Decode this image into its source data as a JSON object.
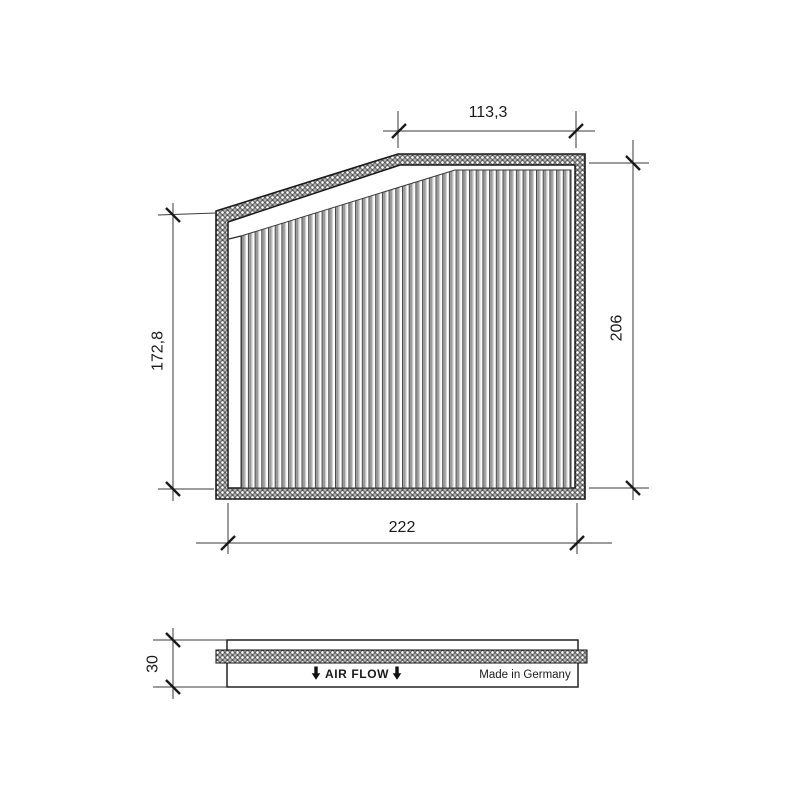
{
  "drawing": {
    "dimensions": {
      "top_width": "113,3",
      "left_height": "172,8",
      "right_height": "206",
      "bottom_width": "222",
      "thickness": "30"
    },
    "labels": {
      "air_flow": "AIR FLOW",
      "made_in": "Made in Germany"
    },
    "colors": {
      "line": "#1a1a1a",
      "pleat_gray": "#9a9a9a",
      "background": "#ffffff"
    }
  }
}
